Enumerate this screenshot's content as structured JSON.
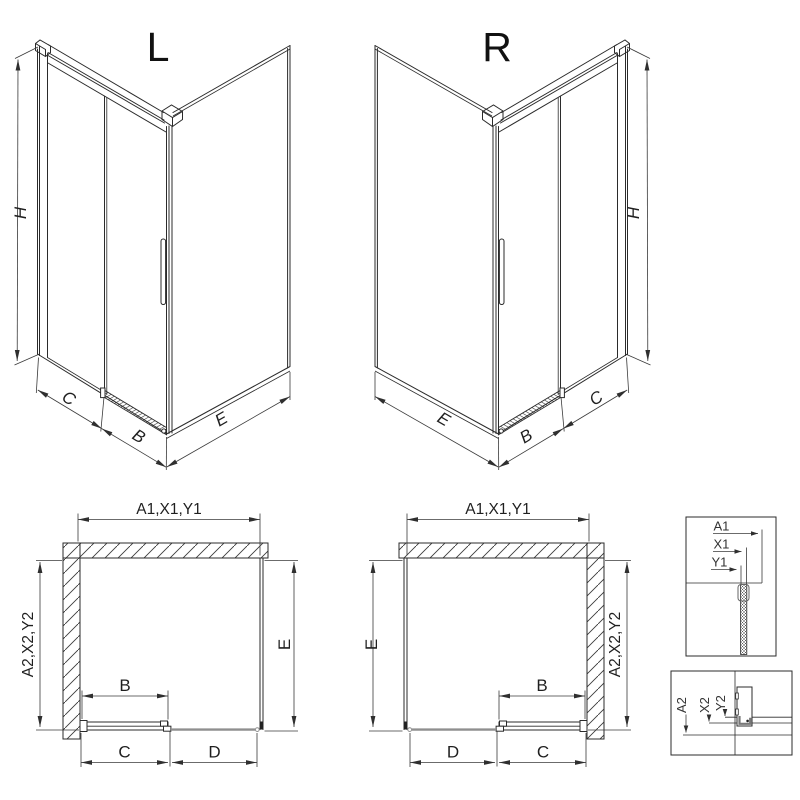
{
  "figure": {
    "type": "technical-drawing",
    "subject": "corner sliding-door shower enclosure dimension diagram, left (L) and right (R) versions with plan views and profile details",
    "colors": {
      "line": "#2b2b2b",
      "dim": "#3a3a3a",
      "gray": "#8f8f8f",
      "background": "#ffffff"
    },
    "iso_left": {
      "variant_label": "L",
      "height_label": "H",
      "fixed_panel_label": "C",
      "door_label": "B",
      "side_panel_label": "E"
    },
    "iso_right": {
      "variant_label": "R",
      "height_label": "H",
      "fixed_panel_label": "C",
      "door_label": "B",
      "side_panel_label": "E"
    },
    "plan_left": {
      "width_label": "A1,X1,Y1",
      "depth_label": "A2,X2,Y2",
      "side_label": "E",
      "door_label": "B",
      "fixed_label": "C",
      "open_label": "D"
    },
    "plan_right": {
      "width_label": "A1,X1,Y1",
      "depth_label": "A2,X2,Y2",
      "side_label": "E",
      "door_label": "B",
      "fixed_label": "C",
      "open_label": "D"
    },
    "detail_width": {
      "labels": [
        "A1",
        "X1",
        "Y1"
      ]
    },
    "detail_depth": {
      "labels": [
        "A2",
        "X2",
        "Y2"
      ]
    }
  }
}
